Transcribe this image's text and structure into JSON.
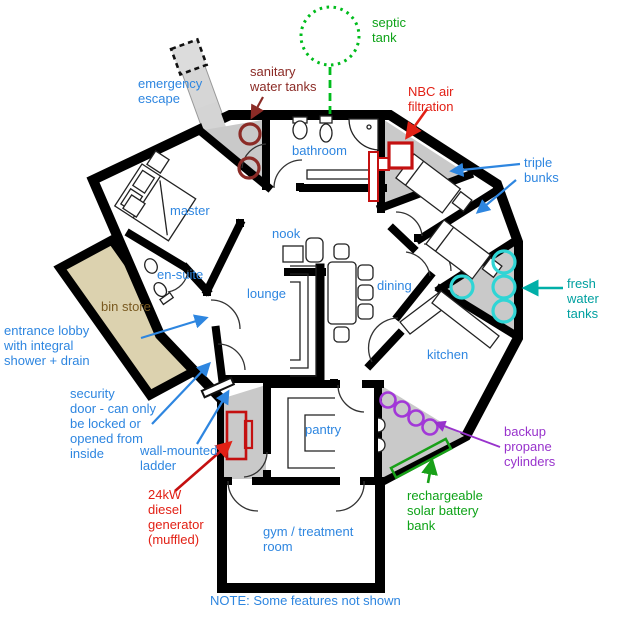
{
  "labels": {
    "septic_tank": "septic\ntank",
    "emergency_escape": "emergency\nescape",
    "sanitary_water_tanks": "sanitary\nwater tanks",
    "nbc_air_filtration": "NBC air\nfiltration",
    "bathroom": "bathroom",
    "triple_bunks": "triple\nbunks",
    "fresh_water_tanks": "fresh water\ntanks",
    "master": "master",
    "nook": "nook",
    "lounge": "lounge",
    "dining": "dining",
    "kitchen": "kitchen",
    "en_suite": "en-suite",
    "bin_store": "bin store",
    "entrance_lobby": "entrance lobby\nwith integral\nshower + drain",
    "security_door": "security\ndoor - can only\nbe locked or\nopened from\ninside",
    "wall_mounted_ladder": "wall-mounted\nladder",
    "diesel_generator": "24kW\ndiesel\ngenerator\n(muffled)",
    "pantry": "pantry",
    "backup_propane": "backup\npropane\ncylinders",
    "solar_battery": "rechargeable\nsolar battery\nbank",
    "gym_treatment": "gym / treatment\nroom",
    "note": "NOTE: Some features not shown"
  },
  "colors": {
    "label_blue": "#2E86E0",
    "label_red": "#E22015",
    "label_dark_red": "#8B2B26",
    "label_green": "#0EA318",
    "label_teal": "#00A0A0",
    "label_purple": "#9833CC",
    "label_tan": "#7A5A20",
    "wall_black": "#000000",
    "plant_room_gray": "#C9C9C9",
    "bin_store_fill": "#DCD2AF",
    "septic_green": "#00BC1C",
    "fresh_tank_cyan": "#30D5D5",
    "propane_purple": "#A238D8",
    "equipment_red": "#C41010",
    "battery_green": "#18A018"
  }
}
